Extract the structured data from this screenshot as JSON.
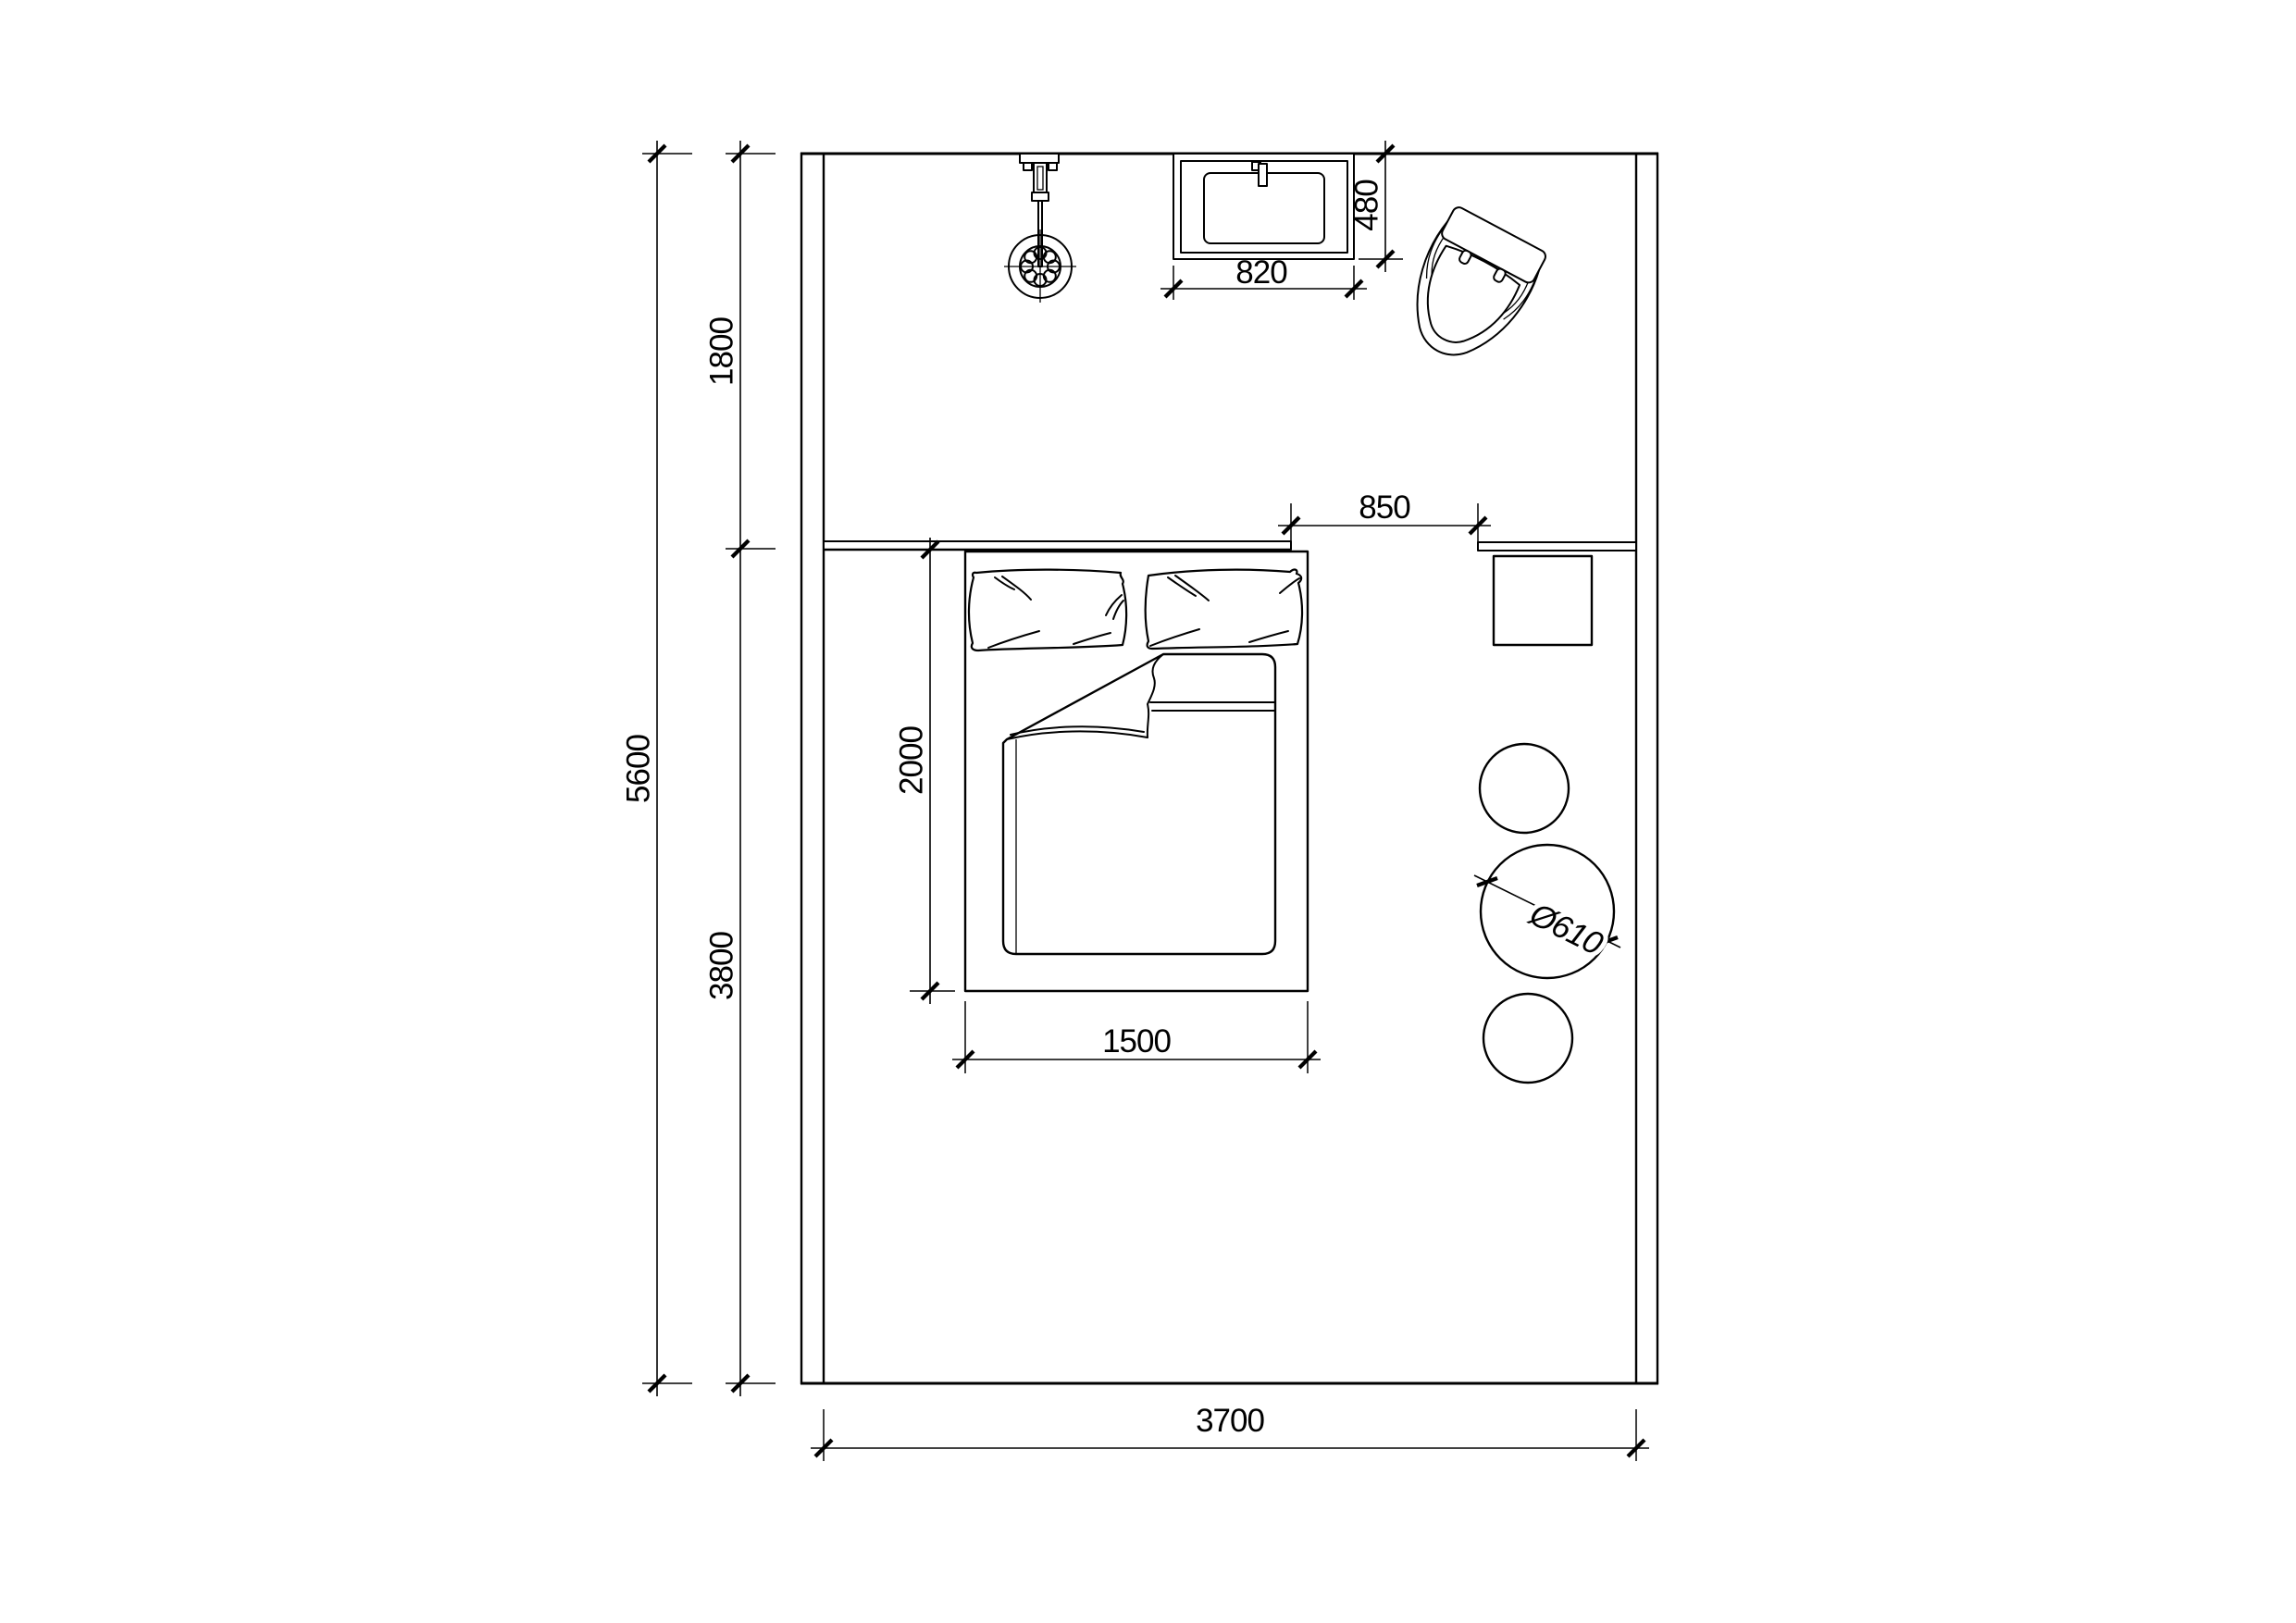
{
  "drawing": {
    "title": "bedroom-bathroom-floor-plan",
    "colors": {
      "line": "#000000",
      "background": "#ffffff"
    },
    "dims": {
      "room_height_total": "5600",
      "bath_zone_depth": "1800",
      "bed_zone_depth": "3800",
      "room_width": "3700",
      "basin_width": "820",
      "basin_depth": "480",
      "passage_width": "850",
      "bed_length": "2000",
      "bed_width": "1500",
      "round_table_diameter": "Ø610"
    },
    "fixtures": {
      "shower": "shower-head-symbol",
      "basin": "washbasin-symbol",
      "toilet": "toilet-symbol",
      "bed": "double-bed-with-pillows-and-duvet",
      "side_table": "square-side-table",
      "round_tables": "round-stool-circles"
    }
  }
}
